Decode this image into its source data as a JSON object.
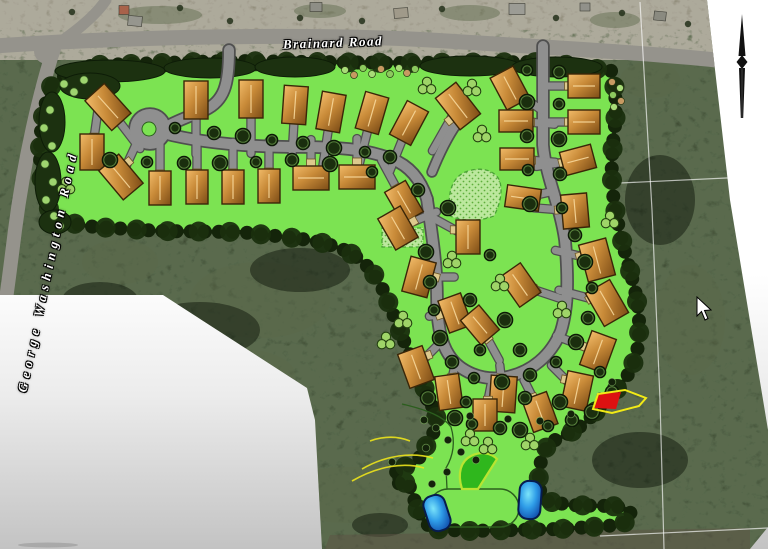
{
  "labels": {
    "brainard": "Brainard Road",
    "george_washington": "George Washington Road"
  },
  "palette": {
    "lawn_green": "#7ce352",
    "forest_dark": "#3d4a31",
    "tree_border": "#14240a",
    "road_gray": "#8f8f8f",
    "road_casing": "#4f4f4f",
    "house_brown": "#c88a38",
    "pond_blue": "#2f9de8",
    "red_area": "#dd1111",
    "contour_yellow": "#ece31c",
    "wedge_green": "#2fb71d",
    "photo_road": "#95938c"
  },
  "photo": {
    "outline": "M0,0 L707,0 L730,200 L768,430 L768,527 L750,549 L322,549 L315,420 L307,388 L163,295 L0,295 Z",
    "roads": [
      {
        "d": "M-5,46 C120,37 300,33 430,40 C560,48 660,54 716,60",
        "w": 15
      },
      {
        "d": "M56,42 C40,90 24,160 15,230 C11,262 8,286 5,306",
        "w": 14
      },
      {
        "d": "M52,48 C72,34 94,18 106,0",
        "w": 11
      }
    ],
    "intersection": [
      47,
      51,
      13
    ],
    "blobs_light": [
      [
        160,
        15,
        42,
        9
      ],
      [
        320,
        11,
        26,
        7
      ],
      [
        470,
        13,
        30,
        8
      ],
      [
        615,
        20,
        25,
        8
      ],
      [
        260,
        300,
        70,
        38
      ],
      [
        580,
        245,
        48,
        32
      ],
      [
        350,
        495,
        75,
        28
      ],
      [
        120,
        262,
        38,
        22
      ],
      [
        690,
        320,
        35,
        55
      ],
      [
        240,
        375,
        55,
        26
      ],
      [
        650,
        80,
        30,
        18
      ]
    ],
    "blobs_dark": [
      [
        200,
        330,
        60,
        28
      ],
      [
        640,
        460,
        48,
        28
      ],
      [
        100,
        300,
        38,
        18
      ],
      [
        380,
        525,
        28,
        12
      ],
      [
        660,
        200,
        35,
        45
      ],
      [
        300,
        270,
        50,
        22
      ]
    ],
    "buildings": [
      [
        124,
        10,
        10,
        9,
        0,
        "#a8624a"
      ],
      [
        135,
        21,
        14,
        10,
        5,
        "#96968e"
      ],
      [
        316,
        7,
        12,
        9,
        0,
        "#8e8e86"
      ],
      [
        401,
        13,
        14,
        10,
        -4,
        "#a09a8a"
      ],
      [
        517,
        9,
        16,
        11,
        0,
        "#9c9c95"
      ],
      [
        585,
        7,
        10,
        8,
        0,
        "#91918a"
      ],
      [
        660,
        16,
        12,
        9,
        6,
        "#8a8a80"
      ]
    ],
    "band_dots": [
      [
        72,
        12
      ],
      [
        180,
        8
      ],
      [
        230,
        21
      ],
      [
        300,
        18
      ],
      [
        362,
        21
      ],
      [
        442,
        9
      ],
      [
        556,
        18
      ],
      [
        622,
        13
      ],
      [
        688,
        24
      ]
    ],
    "bottom_band": "M325,549 L330,535 L750,528 L750,549 Z",
    "survey_lines": [
      "M640,2 L652,210 L660,400 L664,549",
      "M620,183 L768,176",
      "M600,536 L768,528"
    ],
    "contours": [
      "M352,481 C378,466 404,462 424,468",
      "M362,469 C386,455 412,452 433,458",
      "M370,441 C384,436 398,436 410,441"
    ]
  },
  "site": {
    "green_outline": "M52,84 C70,72 82,67 96,65 L230,61 L400,63 L545,62 L612,71 C616,92 617,112 614,134 C611,160 611,180 614,202 C618,228 625,252 632,278 C638,300 641,324 638,346 C634,368 625,382 612,394 C604,402 597,410 589,419 C577,431 561,437 549,443 C543,452 540,462 539,474 C538,486 540,495 546,501 L570,505 L600,506 C622,505 632,510 631,516 C630,522 620,525 606,526 L560,529 L468,531 L433,529 C425,524 419,514 415,502 C412,492 410,486 407,482 C399,486 392,482 395,473 C400,468 406,466 414,464 C420,458 424,450 429,441 C434,432 438,425 436,416 C430,400 420,378 410,355 C400,332 392,310 383,290 C375,272 362,258 344,250 C328,243 310,240 294,238 L240,232 L160,231 L96,227 C76,225 58,221 50,211 C43,196 40,175 40,152 C40,128 44,104 52,84 Z",
    "canopies": [
      [
        110,
        71,
        55,
        11
      ],
      [
        210,
        68,
        46,
        10
      ],
      [
        295,
        67,
        40,
        10
      ],
      [
        470,
        66,
        50,
        10
      ],
      [
        557,
        67,
        45,
        10
      ],
      [
        90,
        86,
        30,
        13
      ],
      [
        52,
        122,
        13,
        30
      ],
      [
        48,
        182,
        13,
        30
      ],
      [
        55,
        222,
        16,
        12
      ]
    ],
    "edge_bushes": [
      [
        50,
        110
      ],
      [
        44,
        128
      ],
      [
        52,
        146
      ],
      [
        45,
        164
      ],
      [
        53,
        182
      ],
      [
        46,
        200
      ],
      [
        54,
        216
      ],
      [
        64,
        84
      ],
      [
        74,
        92
      ],
      [
        84,
        80
      ],
      [
        60,
        226
      ]
    ],
    "shrubs": [
      [
        345,
        70,
        0
      ],
      [
        354,
        75,
        1
      ],
      [
        363,
        68,
        2
      ],
      [
        372,
        74,
        0
      ],
      [
        381,
        69,
        1
      ],
      [
        390,
        74,
        2
      ],
      [
        399,
        68,
        0
      ],
      [
        407,
        73,
        1
      ],
      [
        415,
        69,
        2
      ],
      [
        612,
        82,
        1
      ],
      [
        620,
        88,
        0
      ],
      [
        613,
        95,
        2
      ],
      [
        621,
        101,
        1
      ],
      [
        614,
        107,
        0
      ]
    ],
    "shrub_colors": [
      "#a8dc78",
      "#c79a62",
      "#8cc95e"
    ],
    "roads": [
      {
        "d": "M229,50 C229,85 224,101 205,110 C190,116 176,121 166,127",
        "w": 10
      },
      {
        "d": "M163,133 C205,144 255,147 300,147 C345,147 368,150 392,159 C410,166 421,180 427,199",
        "w": 10
      },
      {
        "d": "M543,46 L543,145 C546,178 560,205 565,240 C568,272 569,305 561,331 C551,356 531,372 507,377 C482,382 459,371 449,355 C439,340 437,318 437,297 C437,267 432,234 427,199",
        "w": 10
      },
      {
        "d": "M432,172 C440,152 448,136 458,122",
        "w": 8
      }
    ],
    "culdesac": {
      "cx": 150,
      "cy": 129,
      "r": 20,
      "island_r": 7
    },
    "houses": [
      [
        108,
        107,
        -42,
        26,
        40,
        20,
        26
      ],
      [
        196,
        100,
        0,
        24,
        38,
        0,
        34
      ],
      [
        251,
        99,
        0,
        24,
        38,
        0,
        34
      ],
      [
        295,
        105,
        4,
        24,
        38,
        -2,
        34
      ],
      [
        331,
        112,
        10,
        24,
        38,
        -5,
        33
      ],
      [
        372,
        113,
        16,
        24,
        38,
        -8,
        32
      ],
      [
        409,
        123,
        28,
        24,
        38,
        -12,
        30
      ],
      [
        458,
        106,
        -38,
        26,
        40,
        -16,
        28
      ],
      [
        92,
        152,
        0,
        24,
        36,
        4,
        -28
      ],
      [
        121,
        177,
        -40,
        26,
        38,
        12,
        -26
      ],
      [
        160,
        188,
        0,
        22,
        34,
        0,
        -28
      ],
      [
        197,
        187,
        0,
        22,
        34,
        0,
        -28
      ],
      [
        233,
        187,
        0,
        22,
        34,
        0,
        -28
      ],
      [
        269,
        186,
        0,
        22,
        34,
        0,
        -28
      ],
      [
        311,
        178,
        0,
        36,
        24,
        0,
        -24
      ],
      [
        357,
        177,
        0,
        36,
        24,
        0,
        -24
      ],
      [
        404,
        202,
        -30,
        24,
        36,
        -14,
        -26
      ],
      [
        510,
        88,
        -28,
        26,
        36,
        20,
        14
      ],
      [
        516,
        121,
        0,
        34,
        22,
        24,
        2
      ],
      [
        517,
        159,
        0,
        34,
        22,
        24,
        2
      ],
      [
        523,
        198,
        8,
        34,
        22,
        18,
        -4
      ],
      [
        584,
        86,
        0,
        32,
        24,
        -26,
        0
      ],
      [
        584,
        122,
        0,
        32,
        24,
        -26,
        0
      ],
      [
        578,
        160,
        -15,
        32,
        24,
        -26,
        4
      ],
      [
        575,
        211,
        -5,
        26,
        34,
        -26,
        -2
      ],
      [
        398,
        228,
        -30,
        26,
        36,
        24,
        -10
      ],
      [
        468,
        237,
        0,
        24,
        34,
        -22,
        -12
      ],
      [
        419,
        277,
        15,
        26,
        36,
        22,
        0
      ],
      [
        455,
        313,
        -20,
        24,
        34,
        -16,
        2
      ],
      [
        597,
        260,
        -15,
        28,
        38,
        -26,
        -6
      ],
      [
        607,
        303,
        -30,
        28,
        38,
        -30,
        -8
      ],
      [
        598,
        352,
        20,
        26,
        36,
        -26,
        -10
      ],
      [
        416,
        367,
        -20,
        26,
        36,
        16,
        -16
      ],
      [
        449,
        392,
        -8,
        24,
        34,
        4,
        -18
      ],
      [
        503,
        394,
        4,
        26,
        36,
        -2,
        -18
      ],
      [
        577,
        391,
        12,
        26,
        36,
        -16,
        -16
      ],
      [
        485,
        415,
        0,
        24,
        32,
        4,
        -20
      ],
      [
        540,
        412,
        -20,
        26,
        34,
        -10,
        -20
      ],
      [
        520,
        285,
        -35,
        26,
        36,
        30,
        10
      ],
      [
        480,
        325,
        -40,
        24,
        32,
        12,
        22
      ]
    ],
    "trees": [
      [
        175,
        128
      ],
      [
        214,
        133
      ],
      [
        243,
        136
      ],
      [
        272,
        140
      ],
      [
        303,
        143
      ],
      [
        334,
        148
      ],
      [
        365,
        152
      ],
      [
        390,
        157
      ],
      [
        110,
        160
      ],
      [
        147,
        162
      ],
      [
        184,
        163
      ],
      [
        220,
        163
      ],
      [
        256,
        162
      ],
      [
        292,
        160
      ],
      [
        330,
        164
      ],
      [
        372,
        172
      ],
      [
        418,
        190
      ],
      [
        448,
        208
      ],
      [
        527,
        70
      ],
      [
        559,
        72
      ],
      [
        527,
        102
      ],
      [
        559,
        104
      ],
      [
        527,
        136
      ],
      [
        559,
        139
      ],
      [
        528,
        170
      ],
      [
        560,
        174
      ],
      [
        530,
        204
      ],
      [
        562,
        208
      ],
      [
        575,
        235
      ],
      [
        585,
        262
      ],
      [
        592,
        288
      ],
      [
        588,
        318
      ],
      [
        576,
        342
      ],
      [
        556,
        362
      ],
      [
        530,
        375
      ],
      [
        502,
        382
      ],
      [
        474,
        378
      ],
      [
        452,
        362
      ],
      [
        440,
        338
      ],
      [
        434,
        310
      ],
      [
        430,
        282
      ],
      [
        426,
        252
      ],
      [
        490,
        255
      ],
      [
        470,
        300
      ],
      [
        505,
        320
      ],
      [
        480,
        350
      ],
      [
        520,
        350
      ],
      [
        428,
        398
      ],
      [
        466,
        402
      ],
      [
        525,
        398
      ],
      [
        560,
        402
      ],
      [
        600,
        372
      ],
      [
        612,
        392
      ],
      [
        455,
        418
      ],
      [
        472,
        424
      ],
      [
        500,
        428
      ],
      [
        520,
        430
      ],
      [
        548,
        426
      ],
      [
        572,
        420
      ],
      [
        592,
        412
      ]
    ],
    "clusters": [
      [
        66,
        186
      ],
      [
        427,
        86
      ],
      [
        472,
        88
      ],
      [
        482,
        134
      ],
      [
        610,
        220
      ],
      [
        500,
        283
      ],
      [
        403,
        320
      ],
      [
        386,
        341
      ],
      [
        452,
        260
      ],
      [
        562,
        310
      ],
      [
        470,
        438
      ],
      [
        488,
        446
      ],
      [
        530,
        442
      ]
    ],
    "dots": [
      [
        424,
        420
      ],
      [
        436,
        428
      ],
      [
        448,
        440
      ],
      [
        426,
        448
      ],
      [
        461,
        452
      ],
      [
        476,
        460
      ],
      [
        392,
        462
      ],
      [
        470,
        416
      ],
      [
        508,
        419
      ],
      [
        540,
        421
      ],
      [
        571,
        414
      ],
      [
        600,
        396
      ],
      [
        612,
        382
      ],
      [
        447,
        472
      ],
      [
        432,
        484
      ]
    ],
    "stipples": [
      "M450,216 C447,192 452,176 468,171 C484,166 497,172 500,182 C503,194 499,206 494,216 C478,222 462,221 450,216 Z",
      "M382,228 L423,228 L423,247 L382,247 Z"
    ],
    "thin_paths": [
      "M402,404 C428,410 444,417 451,427 C456,444 452,458 446,468 L447,489"
    ],
    "oval": {
      "x": 429,
      "y": 489,
      "w": 90,
      "h": 38,
      "r": 19
    },
    "wedge": {
      "d": "M462,489 C457,473 461,461 471,456 C481,451 491,453 497,459 L478,489 Z"
    },
    "ponds": [
      [
        437,
        513,
        22,
        36,
        -18
      ],
      [
        530,
        500,
        22,
        38,
        4
      ]
    ],
    "red_area": {
      "fill_pts": "594,408 599,394 621,392 616,409",
      "outline_pts": "593,409 598,394 625,390 646,398 639,406 612,413"
    }
  },
  "compass": {
    "cx": 742,
    "top": 14,
    "mid": 62,
    "bot": 118
  },
  "cursor": {
    "x": 697,
    "y": 297
  }
}
